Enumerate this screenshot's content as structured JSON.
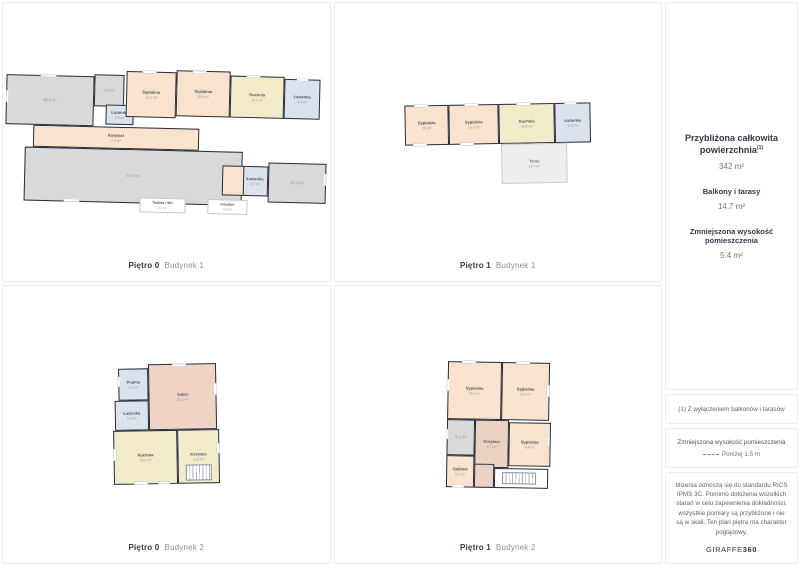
{
  "colors": {
    "wall": "#252e3b",
    "bedroom": "#f9e2ce",
    "kitchen": "#f2ebca",
    "bathroom": "#dbe2ee",
    "neutral": "#d9d9d9",
    "living": "#f1d3c6",
    "hallway": "#ecd2c3",
    "terrace": "#ededed",
    "accent_text": "#2e3947",
    "muted_text": "#8b919b"
  },
  "plans": [
    {
      "id": "b1f0",
      "floor_label": "Piętro 0",
      "building_label": "Budynek 1",
      "rooms": [
        {
          "name": "",
          "area": "38.6 m²",
          "c": "gray"
        },
        {
          "name": "",
          "area": "4.2 m²",
          "c": "gray"
        },
        {
          "name": "Łazienka",
          "area": "2.9 m²",
          "c": "bath"
        },
        {
          "name": "Sypialnia",
          "area": "15.3 m²",
          "c": "bed"
        },
        {
          "name": "Sypialnia",
          "area": "16.8 m²",
          "c": "bed"
        },
        {
          "name": "Kuchnia",
          "area": "13.2 m²",
          "c": "kitchen"
        },
        {
          "name": "Łazienka",
          "area": "4.3 m²",
          "c": "bath"
        },
        {
          "name": "Korytarz",
          "area": "7.6 m²",
          "c": "bed"
        },
        {
          "name": "",
          "area": "47.3 m²",
          "c": "gray"
        },
        {
          "name": "Łazienka",
          "area": "3.3 m²",
          "c": "bath"
        },
        {
          "name": "",
          "area": "23.3 m²",
          "c": "gray"
        },
        {
          "name": "",
          "area": "",
          "c": "bed"
        }
      ],
      "callouts": [
        {
          "name": "Toaleta / WC",
          "area": "2.2 m²"
        },
        {
          "name": "Korytarz",
          "area": "3.2 m²"
        }
      ]
    },
    {
      "id": "b1f1",
      "floor_label": "Piętro 1",
      "building_label": "Budynek 1",
      "rooms": [
        {
          "name": "Sypialnia",
          "area": "16 m²",
          "c": "bed"
        },
        {
          "name": "Sypialnia",
          "area": "13.5 m²",
          "c": "bed"
        },
        {
          "name": "Kuchnia",
          "area": "18.8 m²",
          "c": "kitchen"
        },
        {
          "name": "Łazienka",
          "area": "5.6 m²",
          "c": "bath"
        },
        {
          "name": "Taras",
          "area": "14.7 m²",
          "c": "terrace"
        }
      ],
      "callouts": []
    },
    {
      "id": "b2f0",
      "floor_label": "Piętro 0",
      "building_label": "Budynek 2",
      "rooms": [
        {
          "name": "Pralnia",
          "area": "4.1 m²",
          "c": "bath"
        },
        {
          "name": "Salon",
          "area": "21.2 m²",
          "c": "living"
        },
        {
          "name": "Łazienka",
          "area": "5.4 m²",
          "c": "bath"
        },
        {
          "name": "Kuchnia",
          "area": "18.5 m²",
          "c": "kitchen"
        },
        {
          "name": "Korytarz",
          "area": "5.9 m²",
          "c": "kitchen"
        }
      ],
      "callouts": []
    },
    {
      "id": "b2f1",
      "floor_label": "Piętro 1",
      "building_label": "Budynek 2",
      "rooms": [
        {
          "name": "Sypialnia",
          "area": "14.0 m²",
          "c": "bed"
        },
        {
          "name": "Sypialnia",
          "area": "13.2 m²",
          "c": "bed"
        },
        {
          "name": "",
          "area": "5.1 m²",
          "c": "gray"
        },
        {
          "name": "Korytarz",
          "area": "8.7 m²",
          "c": "hall"
        },
        {
          "name": "Sypialnia",
          "area": "9.4 m²",
          "c": "bed"
        },
        {
          "name": "Gabinet",
          "area": "5.2 m²",
          "c": "bed"
        },
        {
          "name": "",
          "area": "",
          "c": "hall"
        },
        {
          "name": "Poddasze",
          "area": "2.9 m²",
          "c": "attic"
        }
      ],
      "callouts": []
    }
  ],
  "sidebar": {
    "summary": {
      "title": "Przybliżona całkowita powierzchnia",
      "title_sup": "(1)",
      "total_area": "342 m²",
      "balconies_label": "Balkony i tarasy",
      "balconies_area": "14.7 m²",
      "reduced_label": "Zmniejszona wysokość pomieszczenia",
      "reduced_area": "5.4 m²"
    },
    "footnote": "(1) Z wyłączeniem balkonów i tarasów",
    "legend": {
      "title": "Zmniejszona wysokość pomieszczenia",
      "value": "Poniżej 1.5 m"
    },
    "disclaimer": "blizenia odnoszą się do standardu RICS IPMS 3C. Pomimo dołożenia wszelkich starań w celu zapewnienia dokładności, wszystkie pomiary są przybliżone i nie są w skali. Ten plan piętra ma charakter poglądowy.",
    "brand": {
      "name": "GIRAFFE",
      "suffix": "360"
    }
  }
}
